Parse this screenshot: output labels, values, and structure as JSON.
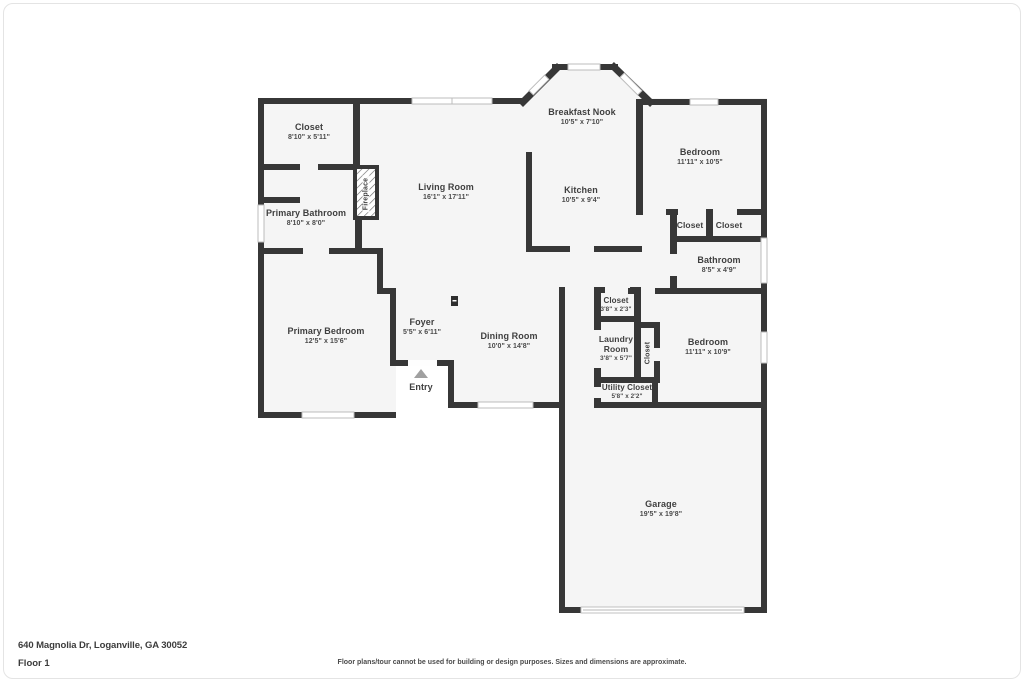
{
  "plan": {
    "colors": {
      "wall": "#373737",
      "floor": "#f5f5f5",
      "window_stroke": "#bcbcbc",
      "text": "#3f3f3f",
      "entry_arrow": "#a0a0a0"
    },
    "rooms": {
      "closet_tl": {
        "label": "Closet",
        "dims": "8'10\" x 5'11\""
      },
      "primary_bathroom": {
        "label": "Primary Bathroom",
        "dims": "8'10\" x 8'0\""
      },
      "living_room": {
        "label": "Living Room",
        "dims": "16'1\" x 17'11\""
      },
      "breakfast_nook": {
        "label": "Breakfast Nook",
        "dims": "10'5\" x 7'10\""
      },
      "kitchen": {
        "label": "Kitchen",
        "dims": "10'5\" x 9'4\""
      },
      "bedroom_top": {
        "label": "Bedroom",
        "dims": "11'11\" x 10'5\""
      },
      "closet_bed_left": {
        "label": "Closet"
      },
      "closet_bed_right": {
        "label": "Closet"
      },
      "bathroom": {
        "label": "Bathroom",
        "dims": "8'5\" x 4'9\""
      },
      "primary_bedroom": {
        "label": "Primary Bedroom",
        "dims": "12'5\" x 15'6\""
      },
      "foyer": {
        "label": "Foyer",
        "dims": "5'5\" x 6'11\""
      },
      "dining_room": {
        "label": "Dining Room",
        "dims": "10'0\" x 14'8\""
      },
      "closet_hall": {
        "label": "Closet",
        "dims": "3'8\" x 2'3\""
      },
      "laundry_room": {
        "label": "Laundry Room",
        "dims": "3'8\" x 5'7\""
      },
      "closet_bed2": {
        "label": "Closet"
      },
      "utility_closet": {
        "label": "Utility Closet",
        "dims": "5'8\" x 2'2\""
      },
      "bedroom_right": {
        "label": "Bedroom",
        "dims": "11'11\" x 10'9\""
      },
      "garage": {
        "label": "Garage",
        "dims": "19'5\" x 19'8\""
      },
      "fireplace": {
        "label": "Fireplace"
      },
      "entry": {
        "label": "Entry"
      }
    }
  },
  "footer": {
    "address": "640 Magnolia Dr, Loganville, GA 30052",
    "floor_label": "Floor 1",
    "disclaimer": "Floor plans/tour cannot be used for building or design purposes. Sizes and dimensions are approximate."
  }
}
